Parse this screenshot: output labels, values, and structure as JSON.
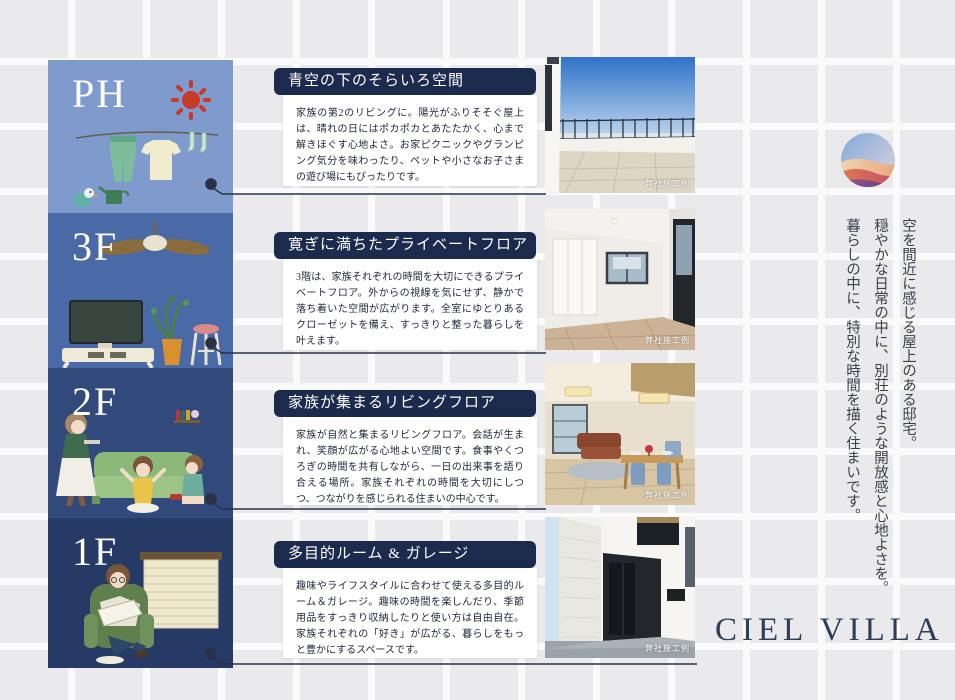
{
  "brand": {
    "logo_text": "CIEL VILLA",
    "logo_icon": "sunset-wave-circle"
  },
  "tagline": {
    "lines": [
      "空を間近に感じる屋上のある邸宅。",
      "穏やかな日常の中に、別荘のような開放感と心地よさを。",
      "暮らしの中に、特別な時間を描く住まいです。"
    ]
  },
  "floors": [
    {
      "label": "PH",
      "block_color": "#7f9bcd",
      "illustration": "laundry-sun-bird-watering-can",
      "title": "青空の下のそらいろ空間",
      "description": "家族の第2のリビングに。陽光がふりそそぐ屋上は、晴れの日にはポカポカとあたたかく、心まで解きほぐす心地よさ。お家ピクニックやグランピング気分を味わったり、ペットや小さなお子さまの遊び場にもぴったりです。",
      "photo_subject": "rooftop-terrace",
      "photo_caption": "弊社施工例"
    },
    {
      "label": "3F",
      "block_color": "#4a69a7",
      "illustration": "ceiling-fan-tv-plant-stool",
      "title": "寛ぎに満ちたプライベートフロア",
      "description": "3階は、家族それぞれの時間を大切にできるプライベートフロア。外からの視線を気にせず、静かで落ち着いた空間が広がります。全室にゆとりあるクローゼットを備え、すっきりと整った暮らしを叶えます。",
      "photo_subject": "private-room-interior",
      "photo_caption": "弊社施工例"
    },
    {
      "label": "2F",
      "block_color": "#32497b",
      "illustration": "family-sofa-living",
      "title": "家族が集まるリビングフロア",
      "description": "家族が自然と集まるリビングフロア。会話が生まれ、笑顔が広がる心地よい空間です。食事やくつろぎの時間を共有しながら、一日の出来事を語り合える場所。家族それぞれの時間を大切にしつつ、つながりを感じられる住まいの中心です。",
      "photo_subject": "living-dining-room",
      "photo_caption": "弊社施工例"
    },
    {
      "label": "1F",
      "block_color": "#253a64",
      "illustration": "man-reading-armchair-window",
      "title": "多目的ルーム & ガレージ",
      "description": "趣味やライフスタイルに合わせて使える多目的ルーム＆ガレージ。趣味の時間を楽しんだり、季節用品をすっきり収納したりと使い方は自由自在。家族それぞれの「好き」が広がる、暮らしをもっと豊かにするスペースです。",
      "photo_subject": "house-exterior-entrance",
      "photo_caption": "弊社施工例"
    }
  ],
  "colors": {
    "title_bar": "#1c2b4d",
    "connector": "#2a3147",
    "wordmark": "#2e3d58",
    "tile_base": "#eaeaec",
    "tile_grout": "#fafafb"
  }
}
